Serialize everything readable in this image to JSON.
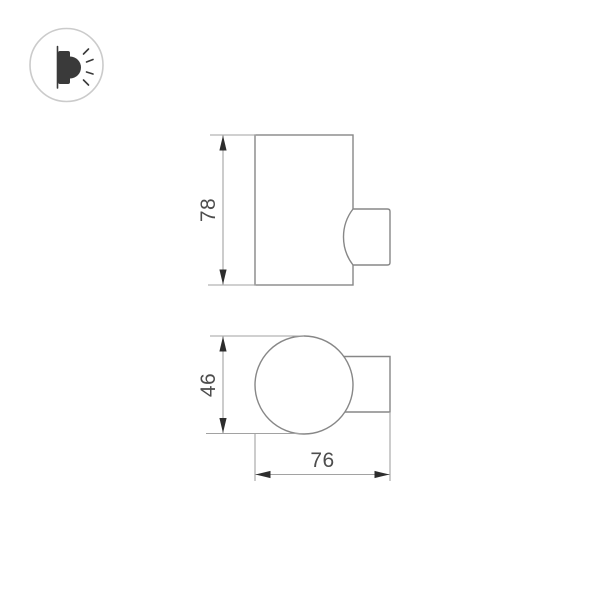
{
  "drawing": {
    "kind": "product-dimension-drawing",
    "dimensions": {
      "height": "78",
      "diameter": "46",
      "depth": "76"
    },
    "icons": {
      "badge": "wall-lamp-icon"
    },
    "colors": {
      "background": "#ffffff",
      "outline": "#878787",
      "dimension_line": "#a2a2a2",
      "arrow": "#2d2d2d",
      "label_text": "#4d4d4d",
      "badge_ring": "#cbcbcb",
      "badge_icon": "#3a3a3a"
    }
  }
}
